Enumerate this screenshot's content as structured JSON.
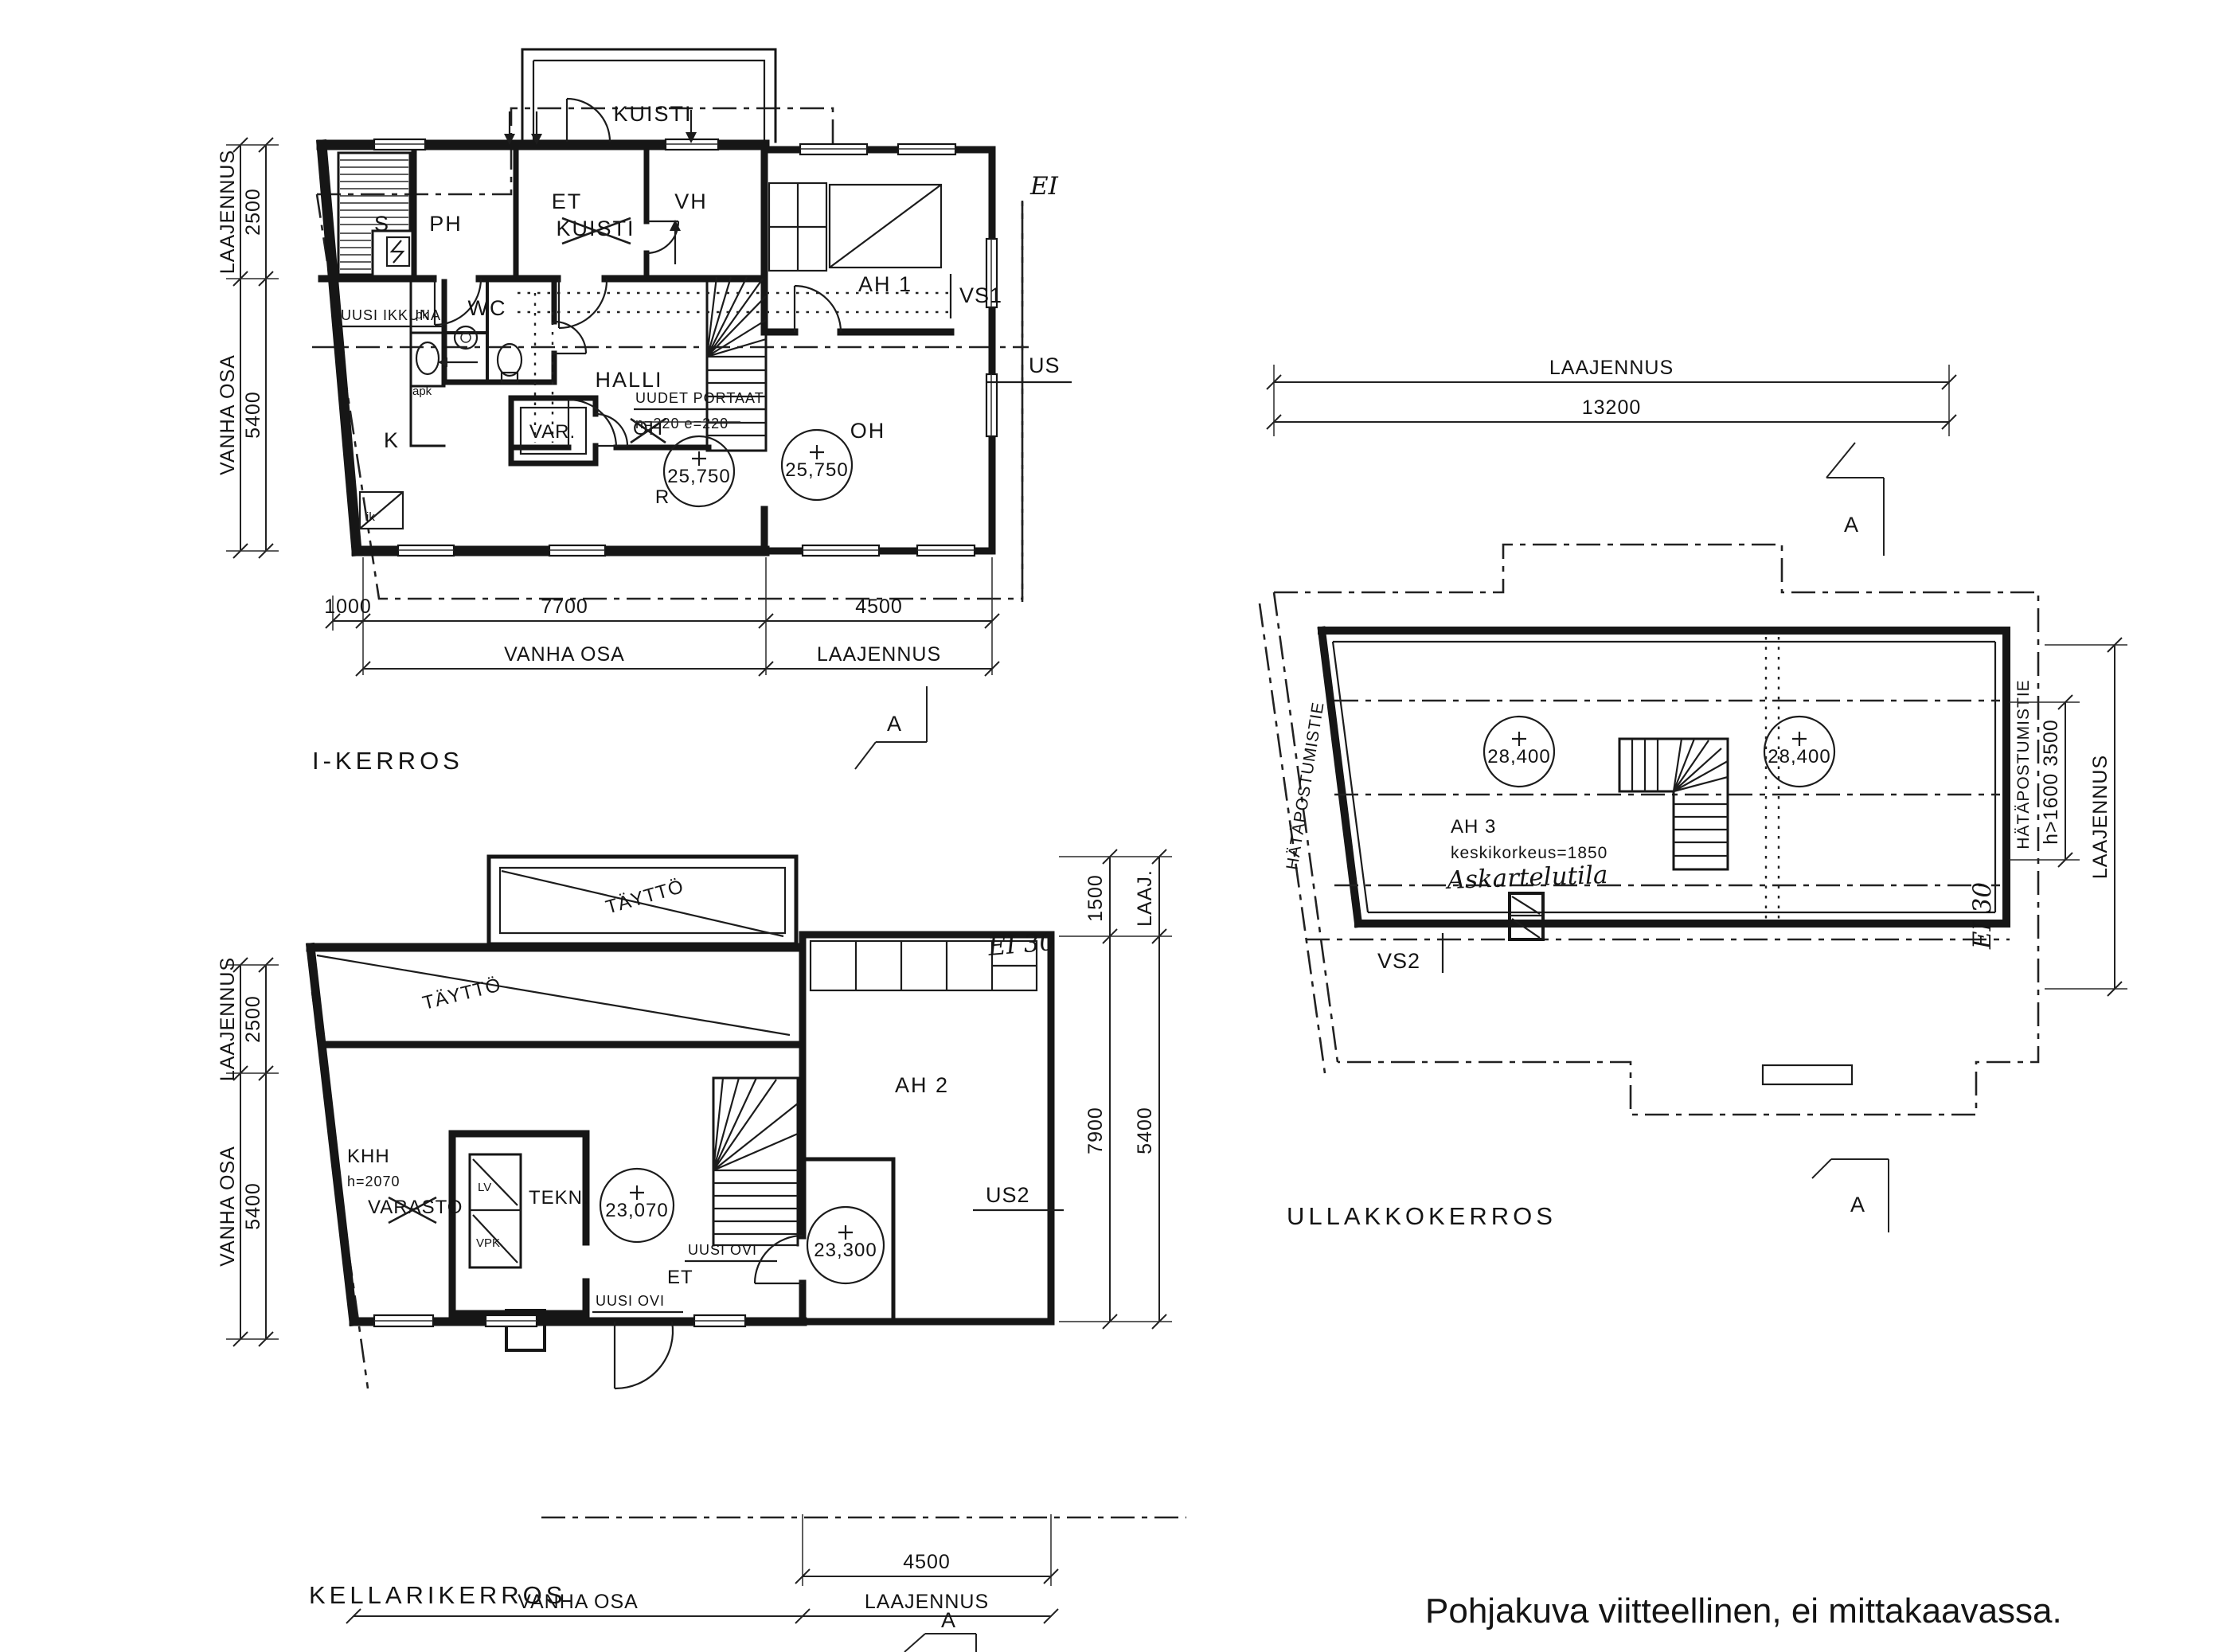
{
  "footer": {
    "note": "Pohjakuva viitteellinen, ei mittakaavassa."
  },
  "floor1": {
    "title": "I-KERROS",
    "rooms": {
      "sauna": "S",
      "washroom": "PH",
      "entry": "ET",
      "closet": "VH",
      "porch": "KUISTI",
      "porch_crossed": "KUISTI",
      "bedroom": "AH 1",
      "living": "OH",
      "hall": "HALLI",
      "kitchen": "K",
      "storage": "VAR.",
      "wc": "WC",
      "r": "R",
      "living_crossed": "OH",
      "fridge": "jk",
      "pk": "pk",
      "apk": "apk"
    },
    "notes": {
      "new_window": "UUSI IKKUNA",
      "new_stairs": "UUDET PORTAAT",
      "stair_dims": "n=220  e=220",
      "hand": "EI"
    },
    "levels": {
      "l1": "25,750",
      "l2": "25,750"
    },
    "tags": {
      "vs1": "VS1",
      "us": "US"
    },
    "dims": {
      "laajennus_v": "LAAJENNUS",
      "v2500": "2500",
      "vanha_v": "VANHA OSA",
      "v5400": "5400",
      "d1000": "1000",
      "d7700": "7700",
      "d4500": "4500",
      "vanha": "VANHA OSA",
      "laajennus": "LAAJENNUS",
      "section": "A"
    }
  },
  "basement": {
    "title": "KELLARIKERROS",
    "rooms": {
      "fill1": "TÄYTTÖ",
      "fill2": "TÄYTTÖ",
      "khh": "KHH",
      "khh_h": "h=2070",
      "varasto": "VARASTO",
      "tekn": "TEKN.",
      "lv": "LV",
      "vpk": "VPK",
      "entry": "ET",
      "hobby": "AH 2"
    },
    "notes": {
      "door1": "UUSI OVI",
      "door2": "UUSI OVI",
      "fire": "EI 30"
    },
    "levels": {
      "l1": "23,070",
      "l2": "23,300"
    },
    "tags": {
      "us2": "US2"
    },
    "dims": {
      "laajennus_v": "LAAJENNUS",
      "v2500": "2500",
      "vanha_v": "VANHA OSA",
      "v5400": "5400",
      "r1500": "1500",
      "rlaaj": "LAAJ.",
      "r7900": "7900",
      "r5400": "5400",
      "d4500": "4500",
      "vanha": "VANHA OSA",
      "laajennus": "LAAJENNUS",
      "section": "A"
    }
  },
  "attic": {
    "title": "ULLAKKOKERROS",
    "rooms": {
      "hobby": "AH 3",
      "height": "keskikorkeus=1850",
      "hand": "Askartelutila"
    },
    "levels": {
      "l1": "28,400",
      "l2": "28,400"
    },
    "notes": {
      "exit_left": "HÄTÄPOSTUMISTIE",
      "exit_right": "HÄTÄPOSTUMISTIE",
      "fire": "EI 30"
    },
    "tags": {
      "vs2": "VS2"
    },
    "dims": {
      "top_label": "LAAJENNUS",
      "top_value": "13200",
      "right_note": "h>1600  3500",
      "right_label": "LAAJENNUS",
      "section_top": "A",
      "section_bottom": "A"
    }
  }
}
